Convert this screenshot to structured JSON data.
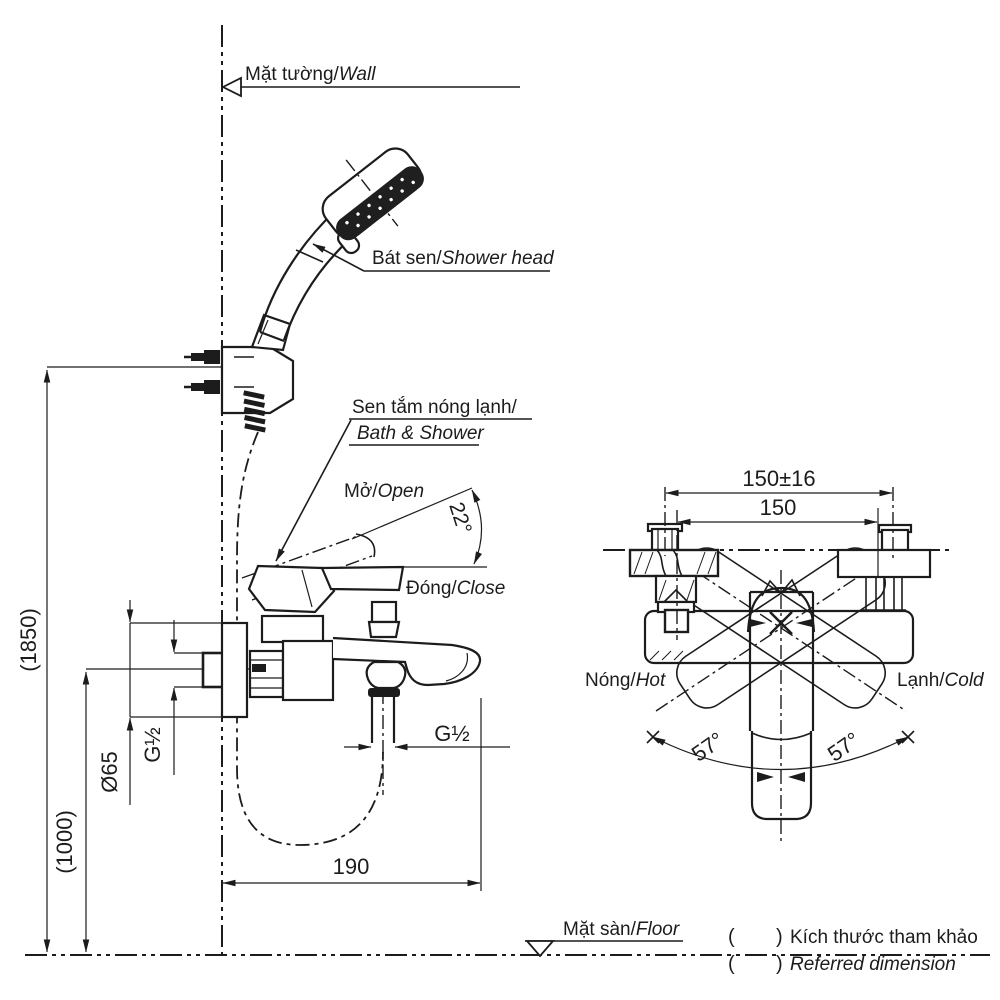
{
  "colors": {
    "ink": "#1c1c1c",
    "paper": "#ffffff"
  },
  "side_view": {
    "wall_label": {
      "vi": "Mặt tường/",
      "en": "Wall"
    },
    "floor_label": {
      "vi": "Mặt sàn/",
      "en": "Floor"
    },
    "shower_head_label": {
      "vi": "Bát sen/",
      "en": "Shower head"
    },
    "mixer_label": {
      "vi": "Sen tắm nóng lạnh/",
      "en": "Bath & Shower"
    },
    "open_label": {
      "vi": "Mở/",
      "en": "Open"
    },
    "close_label": {
      "vi": "Đóng/",
      "en": "Close"
    },
    "open_angle": "22°",
    "dims": {
      "mount_height": "(1850)",
      "mixer_height": "(1000)",
      "escutcheon_dia": "Ø65",
      "inlet_thread": "G½",
      "outlet_thread": "G½",
      "spout_reach": "190"
    }
  },
  "top_view": {
    "hot_label": {
      "vi": "Nóng/",
      "en": "Hot"
    },
    "cold_label": {
      "vi": "Lạnh/",
      "en": "Cold"
    },
    "swing_left": "57°",
    "swing_right": "57°",
    "dims": {
      "inlet_centers_tol": "150±16",
      "inlet_centers": "150"
    }
  },
  "legend": {
    "bracket_open": "(",
    "bracket_close": ")",
    "note_vi": "Kích thước tham khảo",
    "note_en": "Referred dimension"
  }
}
